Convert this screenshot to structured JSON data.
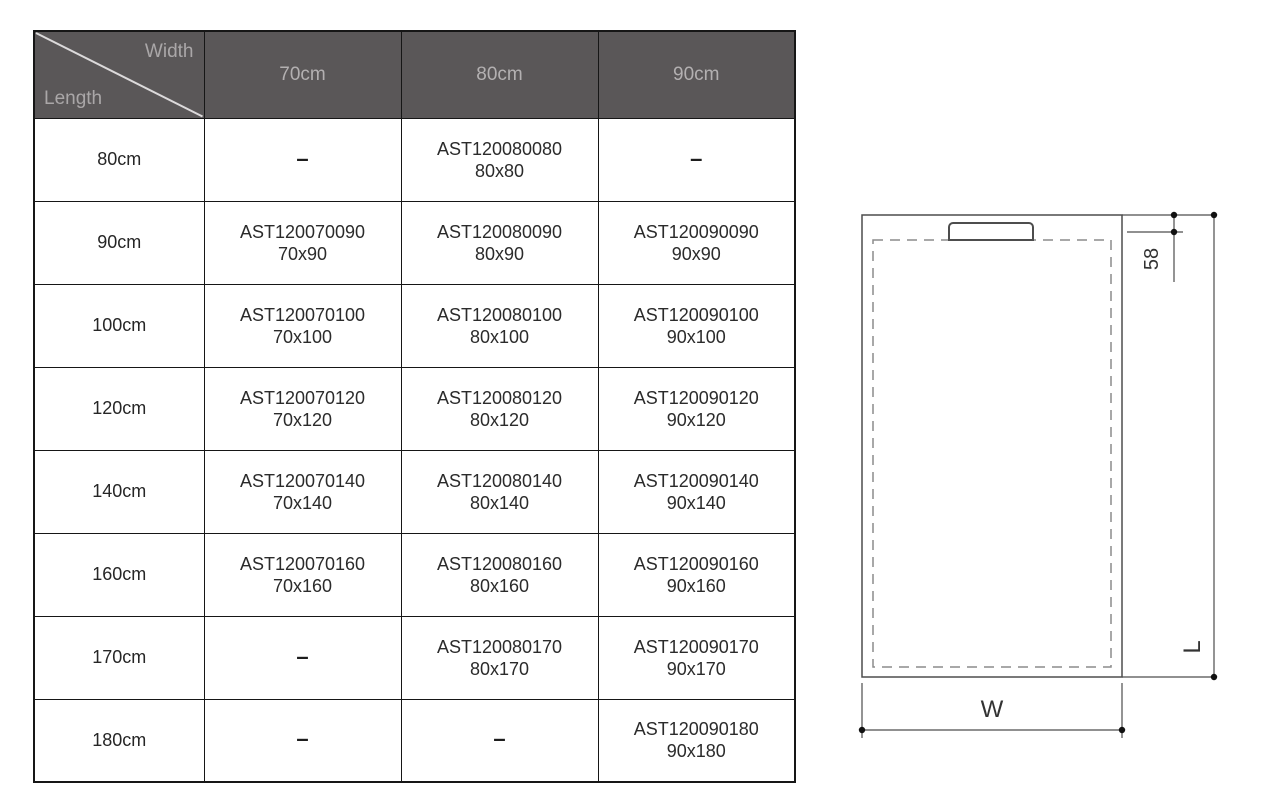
{
  "table": {
    "corner": {
      "width_label": "Width",
      "length_label": "Length"
    },
    "columns": [
      "70cm",
      "80cm",
      "90cm"
    ],
    "dash": "–",
    "rows": [
      {
        "length": "80cm",
        "cells": [
          {
            "dash": true
          },
          {
            "code": "AST120080080",
            "size": "80x80"
          },
          {
            "dash": true
          }
        ]
      },
      {
        "length": "90cm",
        "cells": [
          {
            "code": "AST120070090",
            "size": "70x90"
          },
          {
            "code": "AST120080090",
            "size": "80x90"
          },
          {
            "code": "AST120090090",
            "size": "90x90"
          }
        ]
      },
      {
        "length": "100cm",
        "cells": [
          {
            "code": "AST120070100",
            "size": "70x100"
          },
          {
            "code": "AST120080100",
            "size": "80x100"
          },
          {
            "code": "AST120090100",
            "size": "90x100"
          }
        ]
      },
      {
        "length": "120cm",
        "cells": [
          {
            "code": "AST120070120",
            "size": "70x120"
          },
          {
            "code": "AST120080120",
            "size": "80x120"
          },
          {
            "code": "AST120090120",
            "size": "90x120"
          }
        ]
      },
      {
        "length": "140cm",
        "cells": [
          {
            "code": "AST120070140",
            "size": "70x140"
          },
          {
            "code": "AST120080140",
            "size": "80x140"
          },
          {
            "code": "AST120090140",
            "size": "90x140"
          }
        ]
      },
      {
        "length": "160cm",
        "cells": [
          {
            "code": "AST120070160",
            "size": "70x160"
          },
          {
            "code": "AST120080160",
            "size": "80x160"
          },
          {
            "code": "AST120090160",
            "size": "90x160"
          }
        ]
      },
      {
        "length": "170cm",
        "cells": [
          {
            "dash": true
          },
          {
            "code": "AST120080170",
            "size": "80x170"
          },
          {
            "code": "AST120090170",
            "size": "90x170"
          }
        ]
      },
      {
        "length": "180cm",
        "cells": [
          {
            "dash": true
          },
          {
            "dash": true
          },
          {
            "code": "AST120090180",
            "size": "90x180"
          }
        ]
      }
    ]
  },
  "diagram": {
    "labels": {
      "depth": "58",
      "length": "L",
      "width": "W"
    }
  },
  "colors": {
    "header_bg": "#5a5758",
    "header_text": "#b3b0b1",
    "grid": "#161616",
    "diagram_stroke": "#4d4d4d",
    "diagram_dashed": "#8c8c8c"
  }
}
